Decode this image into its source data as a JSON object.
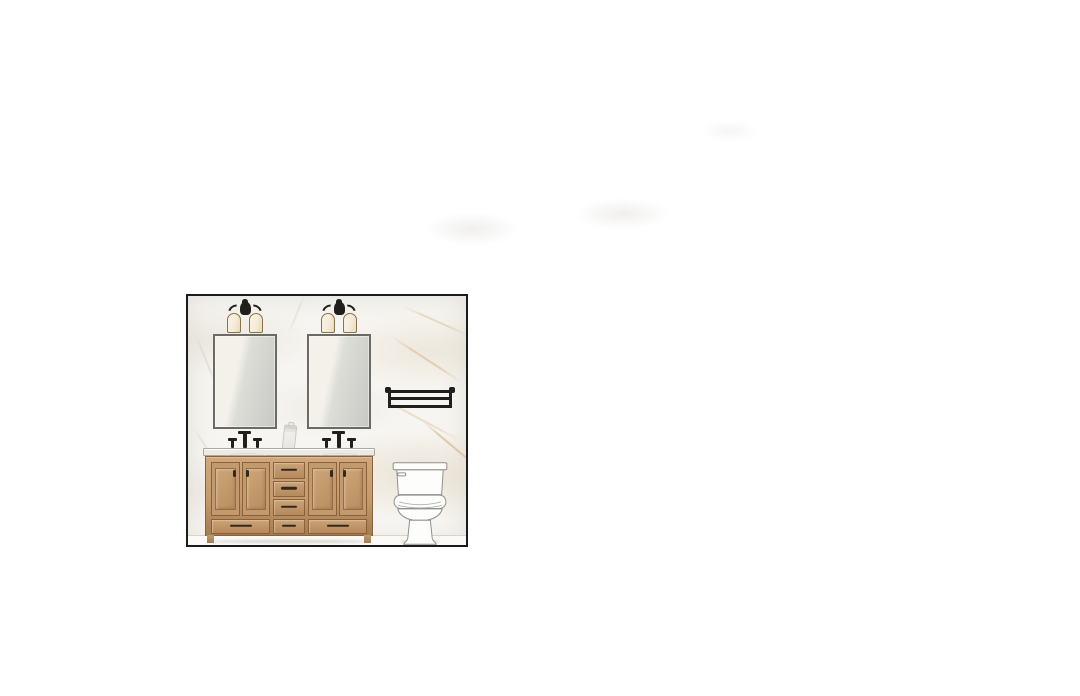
{
  "canvas": {
    "width": 1080,
    "height": 696
  },
  "labels": {
    "board": "Bathroom wall elevation rendering",
    "wall": "White marble wall with gray and gold veining",
    "floor": "White floor strip",
    "sconce_left": "Black two-light wall sconce with cream shades",
    "sconce_right": "Black two-light wall sconce with cream shades",
    "mirror_left": "Rectangular thin-framed vanity mirror",
    "mirror_right": "Rectangular thin-framed vanity mirror",
    "towel_rack": "Black metal train-style towel rack",
    "soap_dispenser": "Sketched soap dispenser on countertop",
    "faucet_left": "Black widespread faucet with two handles",
    "faucet_right": "Black widespread faucet with two handles",
    "countertop": "White stone countertop",
    "vanity": "Light oak double vanity with doors and drawers",
    "toilet": "White two-piece toilet line drawing"
  },
  "colors": {
    "background": "#ffffff",
    "frame": "#1b1b1b",
    "wall": "#f7f5f1",
    "vein_gray": "#d6d0c6",
    "vein_gold": "#d8c196",
    "floor": "#fbfaf6",
    "floor_line": "#d8d4ca",
    "wood": "#c39a6d",
    "wood_light": "#cfa87c",
    "wood_dark": "#a47c50",
    "wood_edge": "#8a6138",
    "hardware": "#312820",
    "counter": "#ebeae5",
    "counter_edge": "#a9a8a2",
    "metal_black": "#211f1d",
    "shade_cream": "#f4ecda",
    "shade_cream_dark": "#e7d9ba",
    "shade_trim": "#8d7243",
    "mirror_frame": "#6b6b66",
    "mirror_light": "#f3f1ea",
    "mirror_dark": "#c8c8c4",
    "toilet_fill": "#fdfdfc",
    "toilet_line": "#8f8f8b",
    "sketch_gray": "#c9c9c4"
  }
}
